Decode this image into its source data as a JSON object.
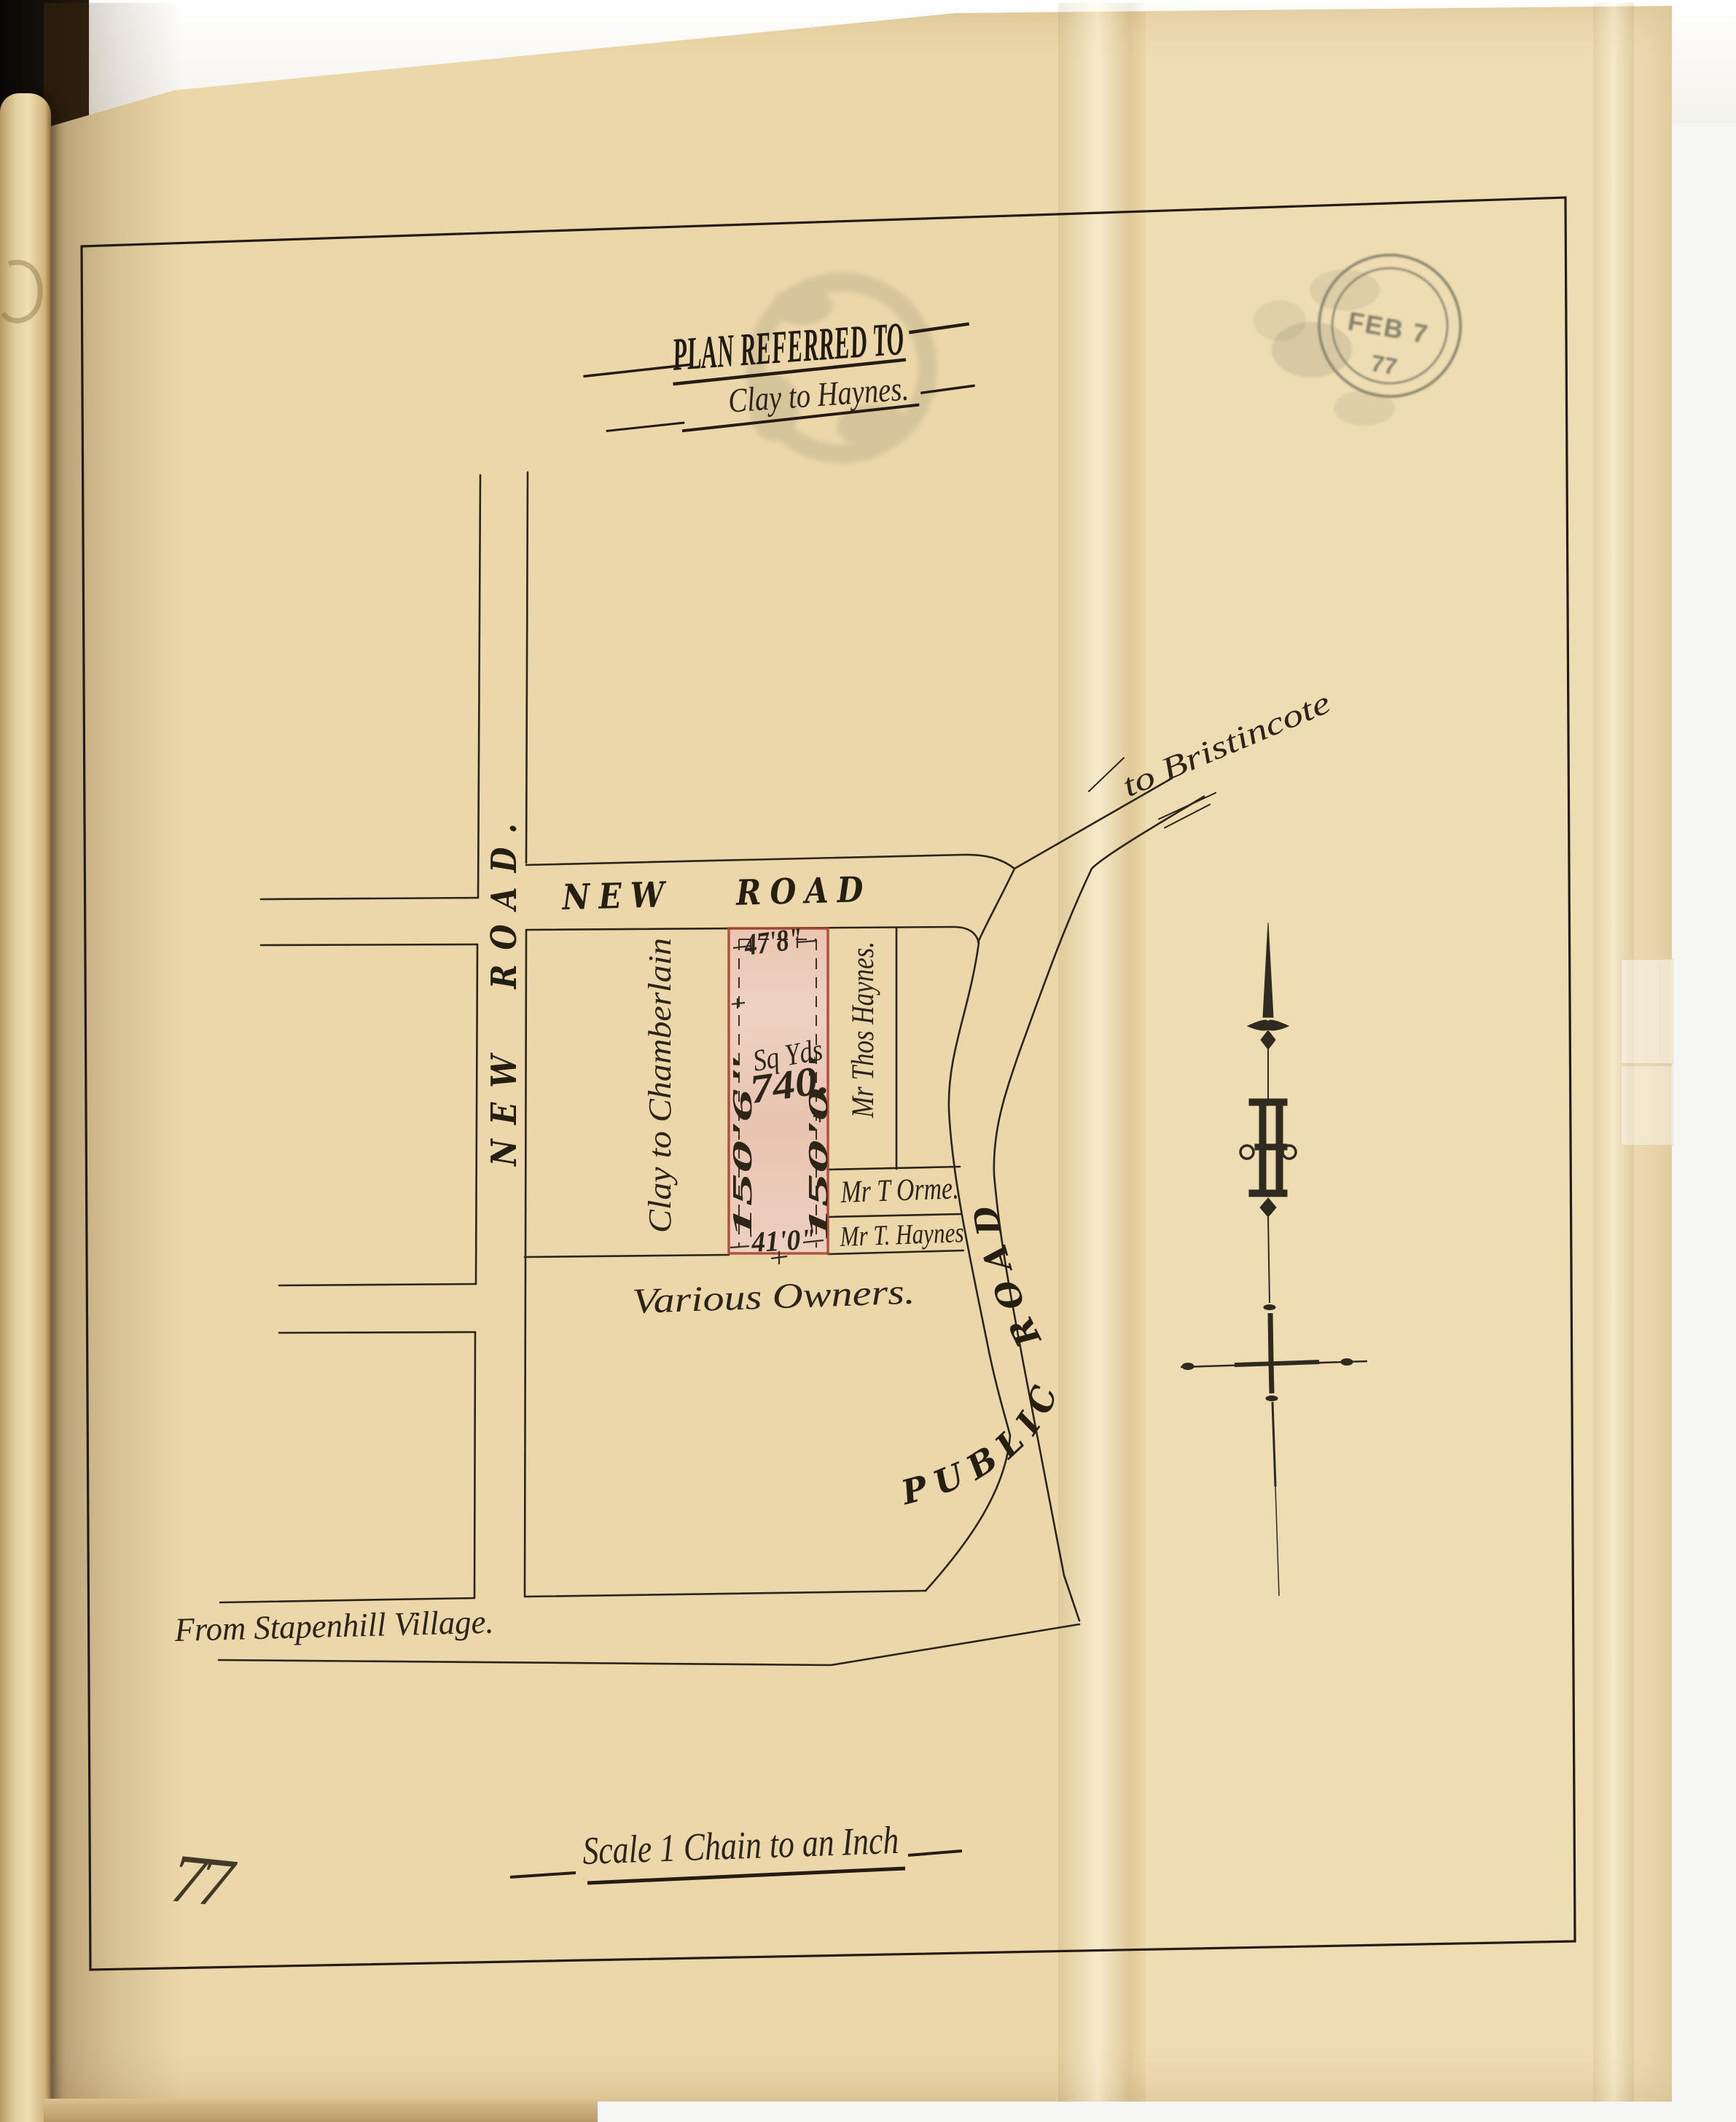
{
  "document": {
    "title": "PLAN REFERRED TO",
    "subtitle": "Clay to Haynes.",
    "scale_caption": "Scale 1 Chain to an Inch",
    "page_annotation": "77"
  },
  "stamp": {
    "date_line": "FEB 7",
    "year_line": "77"
  },
  "roads": {
    "new_road_vertical": "NEW ROAD.",
    "new_road_horizontal": "NEW ROAD",
    "public_road": "PUBLIC ROAD.",
    "to_bristincote": "to Bristincote",
    "from_stapenhill": "From Stapenhill Village."
  },
  "parcels": {
    "clay_to_chamberlain": "Clay to Chamberlain",
    "thos_haynes": "Mr Thos Haynes.",
    "t_orme": "Mr T Orme.",
    "t_haynes": "Mr T. Haynes",
    "various_owners": "Various Owners."
  },
  "plot": {
    "area_unit": "Sq Yds",
    "area_value": "740.",
    "frontage_top": "47'8\"",
    "side_west": "150'6\"",
    "side_east": "150'0\"",
    "frontage_bottom": "41'0\""
  },
  "colors": {
    "plot_fill": "#ecccbe",
    "plot_border": "#a94438",
    "ink": "#2b2419",
    "paper": "#ebd7a9",
    "stamp_ink": "#3f4a40"
  }
}
